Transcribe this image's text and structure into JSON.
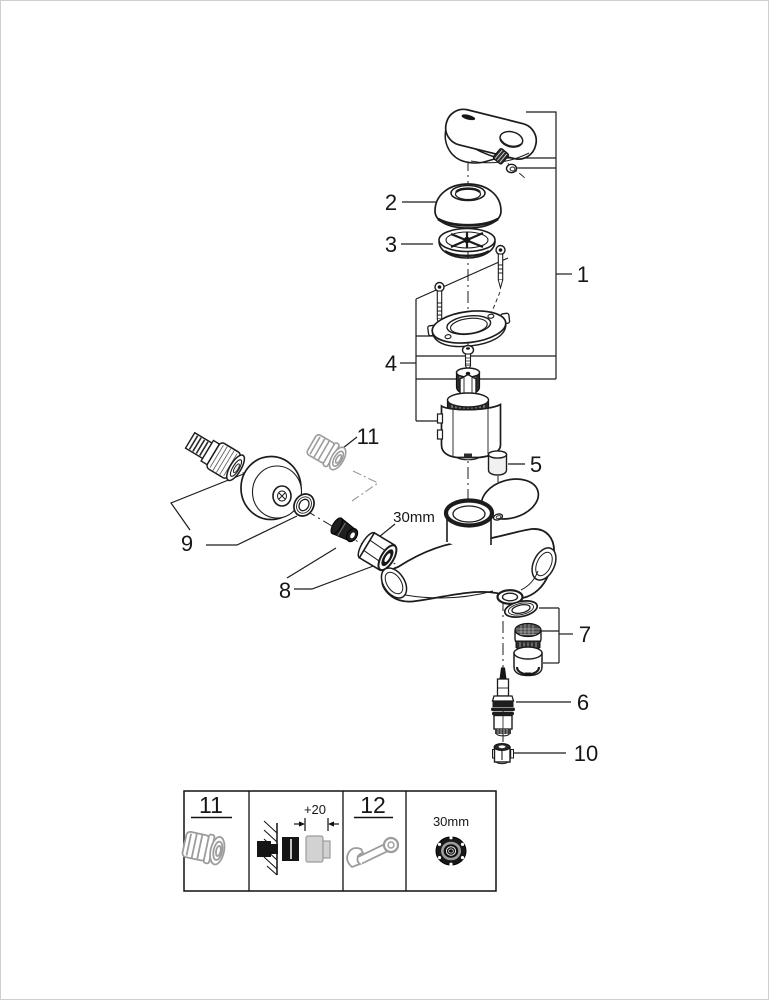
{
  "figure": {
    "type": "exploded-parts-diagram",
    "callouts": {
      "c1": "1",
      "c2": "2",
      "c3": "3",
      "c4": "4",
      "c5": "5",
      "c6": "6",
      "c7": "7",
      "c8": "8",
      "c9": "9",
      "c10": "10",
      "c11": "11"
    },
    "dimensions": {
      "nut_size": "30mm"
    },
    "legend": {
      "cell_11_number": "11",
      "extension_offset": "+20",
      "cell_12_number": "12",
      "nut_size": "30mm"
    },
    "colors": {
      "line": "#1c1c1c",
      "muted_part": "#9c9c9c"
    }
  }
}
